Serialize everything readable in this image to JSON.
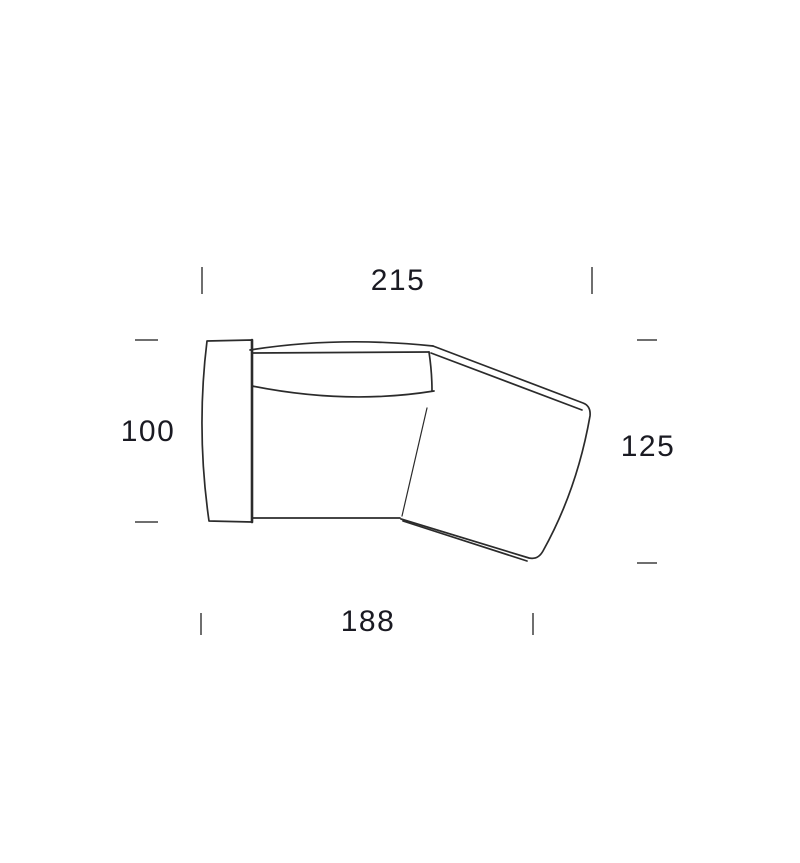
{
  "page": {
    "background": "#ffffff"
  },
  "drawing": {
    "subject": "angled-sofa-module-top-view",
    "line_color": "#2b2b2b",
    "tick_color": "#6f6f6f",
    "text_color": "#1a1a22"
  },
  "dimensions": {
    "top": "215",
    "left": "100",
    "right": "125",
    "bottom": "188"
  }
}
